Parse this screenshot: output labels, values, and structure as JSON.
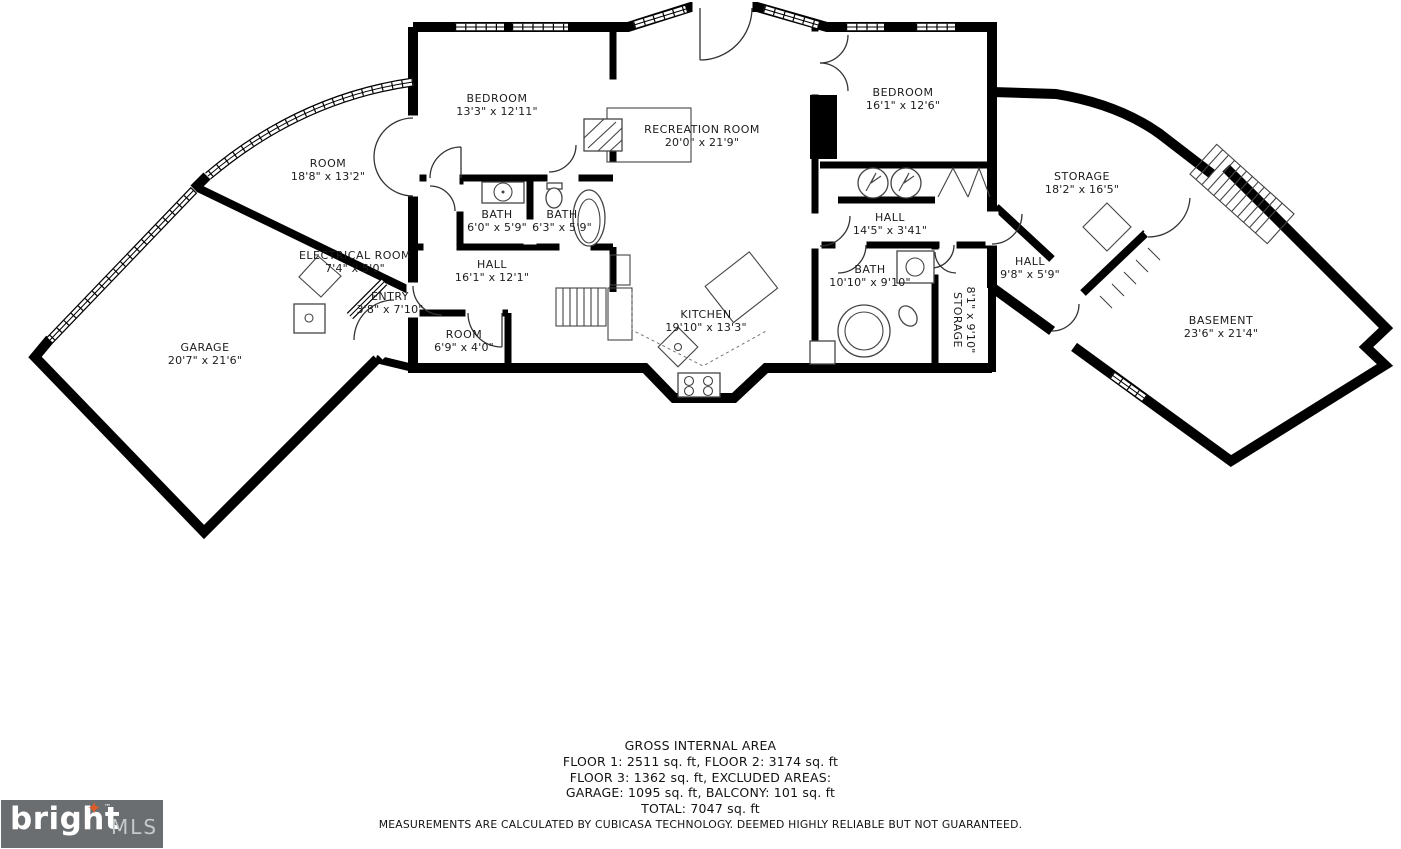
{
  "plan": {
    "rooms": [
      {
        "id": "bedroom-1",
        "name": "BEDROOM",
        "dims": "13'3\" x 12'11\""
      },
      {
        "id": "recreation-room",
        "name": "RECREATION ROOM",
        "dims": "20'0\" x 21'9\""
      },
      {
        "id": "bedroom-2",
        "name": "BEDROOM",
        "dims": "16'1\" x 12'6\""
      },
      {
        "id": "room-left",
        "name": "ROOM",
        "dims": "18'8\" x 13'2\""
      },
      {
        "id": "storage-right",
        "name": "STORAGE",
        "dims": "18'2\" x 16'5\""
      },
      {
        "id": "bath-1",
        "name": "BATH",
        "dims": "6'0\" x 5'9\""
      },
      {
        "id": "bath-2",
        "name": "BATH",
        "dims": "6'3\" x 5'9\""
      },
      {
        "id": "electrical-room",
        "name": "ELECTRICAL ROOM",
        "dims": "7'4\" x 5'0\""
      },
      {
        "id": "entry",
        "name": "ENTRY",
        "dims": "3'8\" x 7'10\""
      },
      {
        "id": "hall-center",
        "name": "HALL",
        "dims": "16'1\" x 12'1\""
      },
      {
        "id": "hall-upper",
        "name": "HALL",
        "dims": "14'5\" x 3'41\""
      },
      {
        "id": "bath-3",
        "name": "BATH",
        "dims": "10'10\" x 9'10\""
      },
      {
        "id": "storage-small",
        "name": "STORAGE",
        "dims": "8'1\" x 9'10\""
      },
      {
        "id": "hall-right",
        "name": "HALL",
        "dims": "9'8\" x 5'9\""
      },
      {
        "id": "kitchen",
        "name": "KITCHEN",
        "dims": "19'10\" x 13'3\""
      },
      {
        "id": "room-small",
        "name": "ROOM",
        "dims": "6'9\" x 4'0\""
      },
      {
        "id": "garage",
        "name": "GARAGE",
        "dims": "20'7\" x 21'6\""
      },
      {
        "id": "basement",
        "name": "BASEMENT",
        "dims": "23'6\" x 21'4\""
      }
    ]
  },
  "footer": {
    "title": "GROSS INTERNAL AREA",
    "line1": "FLOOR 1: 2511 sq. ft, FLOOR 2: 3174 sq. ft",
    "line2": "FLOOR 3: 1362 sq. ft, EXCLUDED AREAS:",
    "line3": "GARAGE: 1095 sq. ft, BALCONY: 101 sq. ft",
    "line4": "TOTAL: 7047 sq. ft",
    "disclaimer": "MEASUREMENTS ARE CALCULATED BY CUBICASA TECHNOLOGY. DEEMED HIGHLY RELIABLE BUT NOT GUARANTEED."
  },
  "logo": {
    "brand": "bright",
    "mls": "MLS",
    "trademark": "™"
  },
  "icons": {
    "logo_star": "✦"
  },
  "colors": {
    "walls": "#000000",
    "background": "#ffffff",
    "logo_background": "#6a6e71",
    "logo_brand_text": "#ffffff",
    "logo_mls_text": "#c6c9ca",
    "logo_star": "#e25b26"
  }
}
